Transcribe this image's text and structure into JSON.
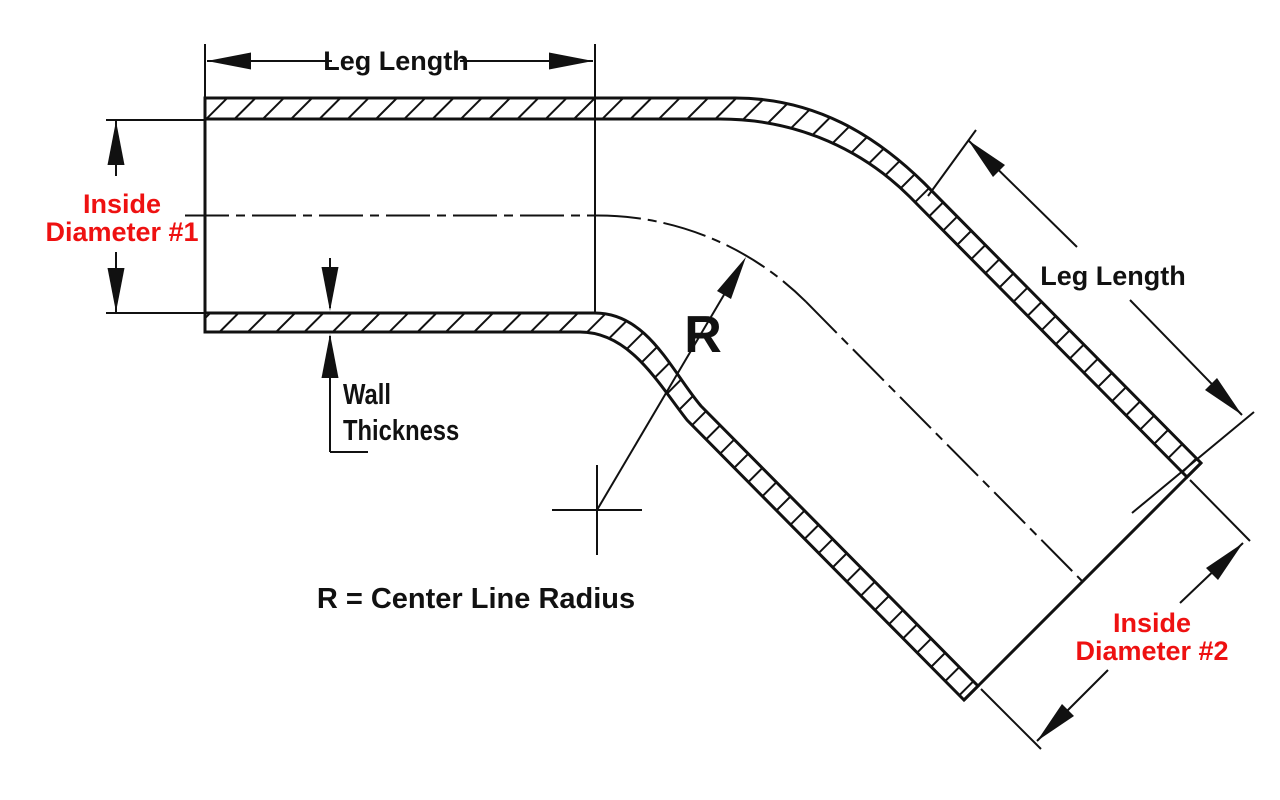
{
  "diagram": {
    "title": "45 degree reducer elbow dimension diagram",
    "background_color": "#ffffff",
    "line_color": "#111111",
    "accent_color": "#ee1111",
    "labels": {
      "leg_length_top": "Leg Length",
      "leg_length_right": "Leg Length",
      "inside_diameter_1_line1": "Inside",
      "inside_diameter_1_line2": "Diameter #1",
      "inside_diameter_2_line1": "Inside",
      "inside_diameter_2_line2": "Diameter #2",
      "wall_thickness_line1": "Wall",
      "wall_thickness_line2": "Thickness",
      "radius_symbol": "R",
      "radius_note": "R = Center Line Radius"
    }
  }
}
